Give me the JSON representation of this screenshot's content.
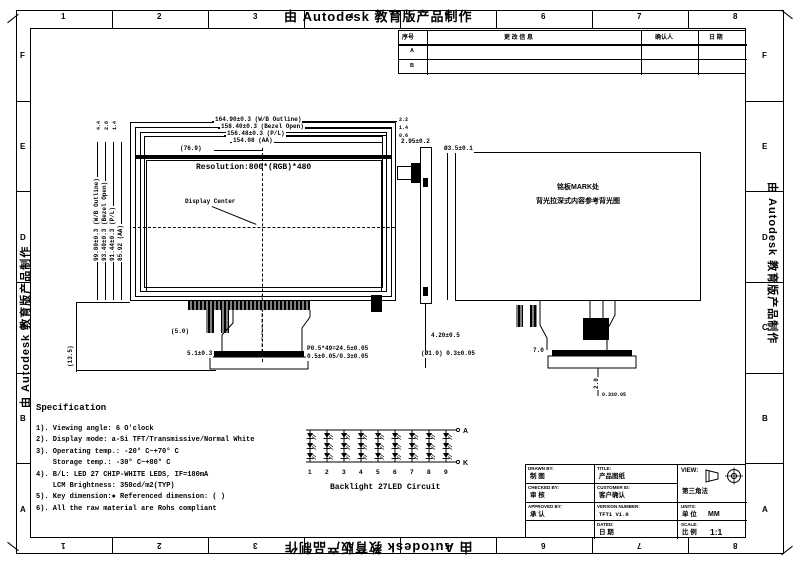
{
  "watermark": {
    "text": "由 Autodesk 教育版产品制作"
  },
  "zones": {
    "cols": [
      "1",
      "2",
      "3",
      "4",
      "5",
      "6",
      "7",
      "8"
    ],
    "rows": [
      "F",
      "E",
      "D",
      "C",
      "B",
      "A"
    ]
  },
  "revision_table": {
    "col_no": "序号",
    "col_desc": "更 改 信 息",
    "col_person": "确认人",
    "col_date": "日 期",
    "rows": [
      "A",
      "B"
    ]
  },
  "front_view": {
    "resolution": "Resolution:800*(RGB)*480",
    "display_center": "Display Center",
    "dim_top_1": "164.90±0.3 (W/B Outline)",
    "dim_top_2": "158.40±0.3 (Bezel Open)",
    "dim_top_3": "156.48±0.3 (P/L)",
    "dim_top_4": "154.08 (AA)",
    "dim_top_short": "(76.9)",
    "dim_left_1": "99.80±0.3 (W/B Outline)",
    "dim_left_2": "93.40±0.3 (Bezel Open)",
    "dim_left_3": "91.44±0.3 (P/L)",
    "dim_left_4": "85.92 (AA)",
    "off_left": [
      "4.4",
      "2.8",
      "1.4"
    ],
    "off_right": [
      "2.2",
      "1.4",
      "0.6"
    ],
    "fpc_dim_1": "P0.5*49=24.5±0.05",
    "fpc_dim_2": "0.5±0.05/0.3±0.05",
    "fpc_dim_3": "5.1±0.3",
    "fpc_dim_4": "(5.0)",
    "fpc_dim_5": "(13.5)"
  },
  "side_view": {
    "dim_top": "2.95±0.2",
    "dim_1": "4.20±0.5",
    "dim_2": "(Ø1.0) 0.3±0.05"
  },
  "rear_view": {
    "note_1": "铭板MARK处",
    "note_2": "背光拉深式内容参考背光图",
    "dim_tl": "Ø3.5±0.1",
    "dim_1": "7.0",
    "dim_2": "2.0",
    "dim_3": "0.3±0.05"
  },
  "led_circuit": {
    "caption": "Backlight 27LED Circuit",
    "numbers": [
      "1",
      "2",
      "3",
      "4",
      "5",
      "6",
      "7",
      "8",
      "9"
    ],
    "anode": "A",
    "cathode": "K",
    "columns": 9,
    "leds_per_column": 3
  },
  "specification": {
    "title": "Specification",
    "items": [
      "1). Viewing angle: 6 O'clock",
      "2). Display mode: a-Si TFT/Transmissive/Normal White",
      "3). Operating temp.: -20° C~+70° C",
      "    Storage temp.: -30° C~+80° C",
      "4). B/L: LED 27 CHIP-WHITE LEDS, IF=180mA",
      "    LCM Brightness: 350cd/m2(TYP)",
      "5). Key dimension:● Referenced dimension: ( )",
      "6). All the raw material are Rohs compliant"
    ]
  },
  "title_block": {
    "drawn_by_label": "DRAWN BY:",
    "drawn_by": "制 图",
    "title_label": "TITLE:",
    "title_value": "产品图纸",
    "checked_by_label": "CHECKED BY:",
    "checked_by": "审 核",
    "customer_label": "CUSTOMER ID:",
    "customer_value": "客户确认",
    "approved_by_label": "APPROVED BY:",
    "approved_by": "承 认",
    "version_label": "VERSION NUMBER:",
    "version_value": "TFT1   V1.0",
    "dated_label": "DATED:",
    "dated_value": "日 期",
    "view_label": "VIEW:",
    "view_value": "第三角法",
    "units_label": "UNITS:",
    "units_cn": "单 位",
    "units_value": "MM",
    "scale_label": "SCALE:",
    "scale_cn": "比 例",
    "scale_value": "1:1"
  }
}
